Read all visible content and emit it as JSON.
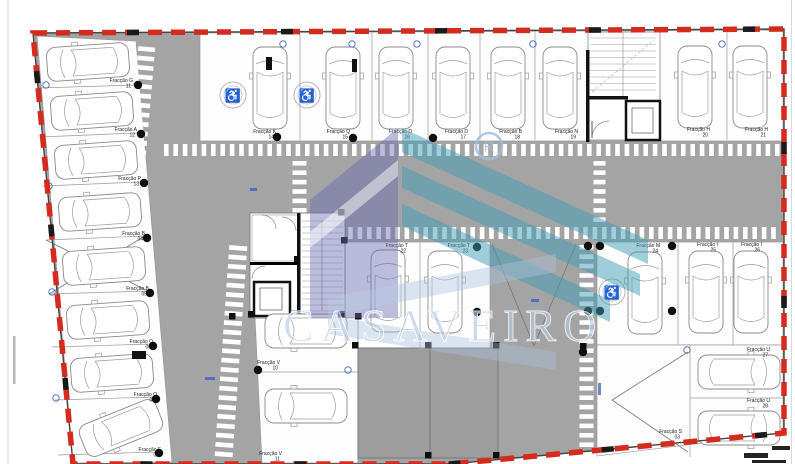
{
  "watermark": {
    "brand": "CASAVEIRO",
    "registered": "R",
    "text_color": "#b6cbe4",
    "building_left": "#6a6ab0",
    "building_right": "#3f9db6",
    "building_light": "#a9c2de"
  },
  "plan": {
    "colors": {
      "boundary_red": "#d42b1e",
      "boundary_black": "#1a1a1a",
      "aisle_gray": "#a4a4a4",
      "zone_white": "#fdfdfd",
      "line_gray": "#8a8a8a",
      "label_color": "#222222",
      "bubble_blue": "#4466bb",
      "mark_blue": "#3a5fbf"
    },
    "boundary_points": [
      [
        33,
        33
      ],
      [
        784,
        29
      ],
      [
        784,
        433
      ],
      [
        450,
        464
      ],
      [
        73,
        464
      ]
    ],
    "zones": [
      {
        "name": "left-parking-column",
        "pts": [
          [
            37,
            36
          ],
          [
            136,
            41
          ],
          [
            172,
            462
          ],
          [
            73,
            463
          ]
        ]
      },
      {
        "name": "top-parking-row",
        "pts": [
          [
            200,
            33
          ],
          [
            783,
            30
          ],
          [
            783,
            141
          ],
          [
            200,
            141
          ]
        ]
      },
      {
        "name": "stair-core-center",
        "pts": [
          [
            250,
            213
          ],
          [
            345,
            213
          ],
          [
            345,
            318
          ],
          [
            250,
            318
          ]
        ]
      },
      {
        "name": "t-parking-zone",
        "pts": [
          [
            345,
            242
          ],
          [
            490,
            242
          ],
          [
            490,
            348
          ],
          [
            345,
            348
          ]
        ]
      },
      {
        "name": "mi-parking-zone",
        "pts": [
          [
            597,
            242
          ],
          [
            783,
            242
          ],
          [
            783,
            345
          ],
          [
            597,
            345
          ]
        ]
      },
      {
        "name": "su-parking-zone",
        "pts": [
          [
            597,
            345
          ],
          [
            783,
            345
          ],
          [
            783,
            433
          ],
          [
            597,
            456
          ]
        ]
      },
      {
        "name": "v-parking-zone",
        "pts": [
          [
            255,
            318
          ],
          [
            358,
            318
          ],
          [
            358,
            463
          ],
          [
            262,
            463
          ]
        ]
      }
    ],
    "gray_boxes": [
      {
        "x": 358,
        "y": 348,
        "w": 72,
        "h": 110
      },
      {
        "x": 430,
        "y": 348,
        "w": 68,
        "h": 110
      }
    ],
    "bands": [
      {
        "x": 137,
        "y": 44,
        "w": 20,
        "h": 420,
        "dir": "v",
        "rot": 5
      },
      {
        "x": 162,
        "y": 143,
        "w": 620,
        "h": 14,
        "dir": "h",
        "rot": 0
      },
      {
        "x": 318,
        "y": 226,
        "w": 464,
        "h": 14,
        "dir": "h",
        "rot": 0
      },
      {
        "x": 291,
        "y": 159,
        "w": 17,
        "h": 66,
        "dir": "v",
        "rot": 0
      },
      {
        "x": 592,
        "y": 159,
        "w": 15,
        "h": 66,
        "dir": "v",
        "rot": 0
      },
      {
        "x": 228,
        "y": 243,
        "w": 21,
        "h": 218,
        "dir": "v",
        "rot": 4
      },
      {
        "x": 578,
        "y": 243,
        "w": 17,
        "h": 213,
        "dir": "v",
        "rot": 0
      }
    ],
    "spaces": [
      {
        "name": "Fracção G",
        "num": "11",
        "x": 133,
        "y": 82
      },
      {
        "name": "Fracção A",
        "num": "12",
        "x": 137,
        "y": 131
      },
      {
        "name": "Fracção P",
        "num": "13",
        "x": 141,
        "y": 180
      },
      {
        "name": "Fracção B",
        "num": "04",
        "x": 145,
        "y": 235
      },
      {
        "name": "Fracção B",
        "num": "05",
        "x": 149,
        "y": 290
      },
      {
        "name": "Fracção Q",
        "num": "06",
        "x": 153,
        "y": 343
      },
      {
        "name": "Fracção Q",
        "num": "07",
        "x": 157,
        "y": 396
      },
      {
        "name": "Fracção F",
        "num": "08",
        "x": 161,
        "y": 451
      },
      {
        "name": "Fracção K",
        "num": "14",
        "x": 276,
        "y": 133
      },
      {
        "name": "Fracção Q",
        "num": "15",
        "x": 350,
        "y": 133
      },
      {
        "name": "Fracção D",
        "num": "16",
        "x": 412,
        "y": 133
      },
      {
        "name": "Fracção D",
        "num": "17",
        "x": 468,
        "y": 133
      },
      {
        "name": "Fracção B",
        "num": "18",
        "x": 522,
        "y": 133
      },
      {
        "name": "Fracção N",
        "num": "19",
        "x": 578,
        "y": 133
      },
      {
        "name": "Fracção H",
        "num": "20",
        "x": 710,
        "y": 131
      },
      {
        "name": "Fracção H",
        "num": "21",
        "x": 768,
        "y": 131
      },
      {
        "name": "Fracção T",
        "num": "22",
        "x": 408,
        "y": 247
      },
      {
        "name": "Fracção T",
        "num": "23",
        "x": 470,
        "y": 247
      },
      {
        "name": "Fracção M",
        "num": "24",
        "x": 660,
        "y": 247
      },
      {
        "name": "Fracção I",
        "num": "25",
        "x": 718,
        "y": 246
      },
      {
        "name": "Fracção I",
        "num": "26",
        "x": 762,
        "y": 246
      },
      {
        "name": "Fracção V",
        "num": "10",
        "x": 280,
        "y": 364
      },
      {
        "name": "Fracção V",
        "num": "11",
        "x": 282,
        "y": 455
      },
      {
        "name": "Fracção U",
        "num": "27",
        "x": 770,
        "y": 351
      },
      {
        "name": "Fracção U",
        "num": "28",
        "x": 770,
        "y": 402
      },
      {
        "name": "Fracção S",
        "num": "03",
        "x": 682,
        "y": 433
      }
    ],
    "cars": [
      {
        "x": 88,
        "y": 62,
        "r": 266
      },
      {
        "x": 92,
        "y": 111,
        "r": 266
      },
      {
        "x": 96,
        "y": 160,
        "r": 266
      },
      {
        "x": 100,
        "y": 212,
        "r": 266
      },
      {
        "x": 104,
        "y": 266,
        "r": 266
      },
      {
        "x": 108,
        "y": 320,
        "r": 266
      },
      {
        "x": 112,
        "y": 373,
        "r": 266
      },
      {
        "x": 121,
        "y": 428,
        "r": 248
      },
      {
        "x": 270,
        "y": 88,
        "r": 0
      },
      {
        "x": 343,
        "y": 88,
        "r": 0
      },
      {
        "x": 396,
        "y": 88,
        "r": 0
      },
      {
        "x": 453,
        "y": 88,
        "r": 0
      },
      {
        "x": 508,
        "y": 88,
        "r": 0
      },
      {
        "x": 560,
        "y": 88,
        "r": 0
      },
      {
        "x": 695,
        "y": 87,
        "r": 0
      },
      {
        "x": 750,
        "y": 87,
        "r": 0
      },
      {
        "x": 645,
        "y": 293,
        "r": 0
      },
      {
        "x": 706,
        "y": 292,
        "r": 0
      },
      {
        "x": 751,
        "y": 292,
        "r": 0
      },
      {
        "x": 388,
        "y": 291,
        "r": 0
      },
      {
        "x": 445,
        "y": 292,
        "r": 0
      },
      {
        "x": 306,
        "y": 331,
        "r": 270
      },
      {
        "x": 306,
        "y": 406,
        "r": 270
      },
      {
        "x": 739,
        "y": 372,
        "r": 90
      },
      {
        "x": 739,
        "y": 428,
        "r": 90
      }
    ],
    "handicap": [
      {
        "x": 233,
        "y": 95
      },
      {
        "x": 307,
        "y": 95
      },
      {
        "x": 612,
        "y": 292
      }
    ],
    "lines": [
      [
        38,
        88,
        135,
        85
      ],
      [
        40,
        137,
        138,
        133
      ],
      [
        43,
        186,
        141,
        182
      ],
      [
        46,
        240,
        145,
        236
      ],
      [
        49,
        294,
        148,
        291
      ],
      [
        52,
        347,
        151,
        344
      ],
      [
        55,
        400,
        155,
        397
      ],
      [
        58,
        455,
        158,
        452
      ],
      [
        300,
        33,
        300,
        140
      ],
      [
        372,
        32,
        372,
        140
      ],
      [
        428,
        32,
        428,
        140
      ],
      [
        480,
        32,
        480,
        140
      ],
      [
        535,
        31,
        535,
        140
      ],
      [
        727,
        31,
        727,
        140
      ],
      [
        678,
        242,
        678,
        345
      ],
      [
        733,
        242,
        733,
        345
      ],
      [
        690,
        398,
        783,
        398
      ],
      [
        420,
        242,
        420,
        348
      ],
      [
        255,
        372,
        358,
        372
      ],
      [
        690,
        345,
        690,
        457
      ],
      [
        358,
        318,
        358,
        462
      ]
    ],
    "xlines": [
      [
        46,
        240,
        148,
        291
      ],
      [
        49,
        294,
        145,
        236
      ],
      [
        492,
        244,
        534,
        346
      ],
      [
        534,
        346,
        576,
        244
      ],
      [
        688,
        352,
        612,
        400
      ],
      [
        612,
        400,
        688,
        452
      ],
      [
        358,
        348,
        430,
        458
      ],
      [
        430,
        348,
        358,
        458
      ],
      [
        430,
        348,
        498,
        458
      ],
      [
        498,
        348,
        430,
        458
      ]
    ],
    "dots": [
      [
        138,
        85
      ],
      [
        141,
        134
      ],
      [
        144,
        183
      ],
      [
        147,
        238
      ],
      [
        150,
        293
      ],
      [
        153,
        346
      ],
      [
        156,
        399
      ],
      [
        159,
        453
      ],
      [
        277,
        137
      ],
      [
        353,
        138
      ],
      [
        433,
        138
      ],
      [
        477,
        247
      ],
      [
        477,
        312
      ],
      [
        588,
        246
      ],
      [
        588,
        311
      ],
      [
        600,
        246
      ],
      [
        672,
        246
      ],
      [
        600,
        311
      ],
      [
        672,
        311
      ],
      [
        258,
        370
      ],
      [
        583,
        352
      ]
    ],
    "squares": [
      [
        355,
        345
      ],
      [
        428,
        345
      ],
      [
        496,
        345
      ],
      [
        428,
        455
      ],
      [
        496,
        455
      ],
      [
        358,
        316
      ],
      [
        344,
        240
      ],
      [
        297,
        259
      ],
      [
        341,
        212
      ],
      [
        341,
        314
      ],
      [
        251,
        314
      ],
      [
        583,
        346
      ],
      [
        232,
        316
      ]
    ],
    "bars": [
      [
        266,
        57,
        6,
        13
      ],
      [
        352,
        59,
        5,
        13
      ],
      [
        132,
        351,
        14,
        8
      ]
    ],
    "bubbles": [
      [
        46,
        85
      ],
      [
        49,
        186
      ],
      [
        52,
        292
      ],
      [
        56,
        398
      ],
      [
        283,
        44
      ],
      [
        352,
        44
      ],
      [
        417,
        44
      ],
      [
        533,
        44
      ],
      [
        722,
        44
      ],
      [
        348,
        370
      ],
      [
        687,
        350
      ]
    ],
    "blue_marks": [
      [
        205,
        377,
        10,
        3
      ],
      [
        531,
        299,
        8,
        3
      ],
      [
        598,
        383,
        3,
        12
      ],
      [
        250,
        188,
        7,
        3
      ]
    ],
    "stamp_fragments": [
      [
        744,
        453,
        24,
        5
      ],
      [
        772,
        446,
        18,
        4
      ],
      [
        752,
        460,
        34,
        3
      ]
    ]
  }
}
